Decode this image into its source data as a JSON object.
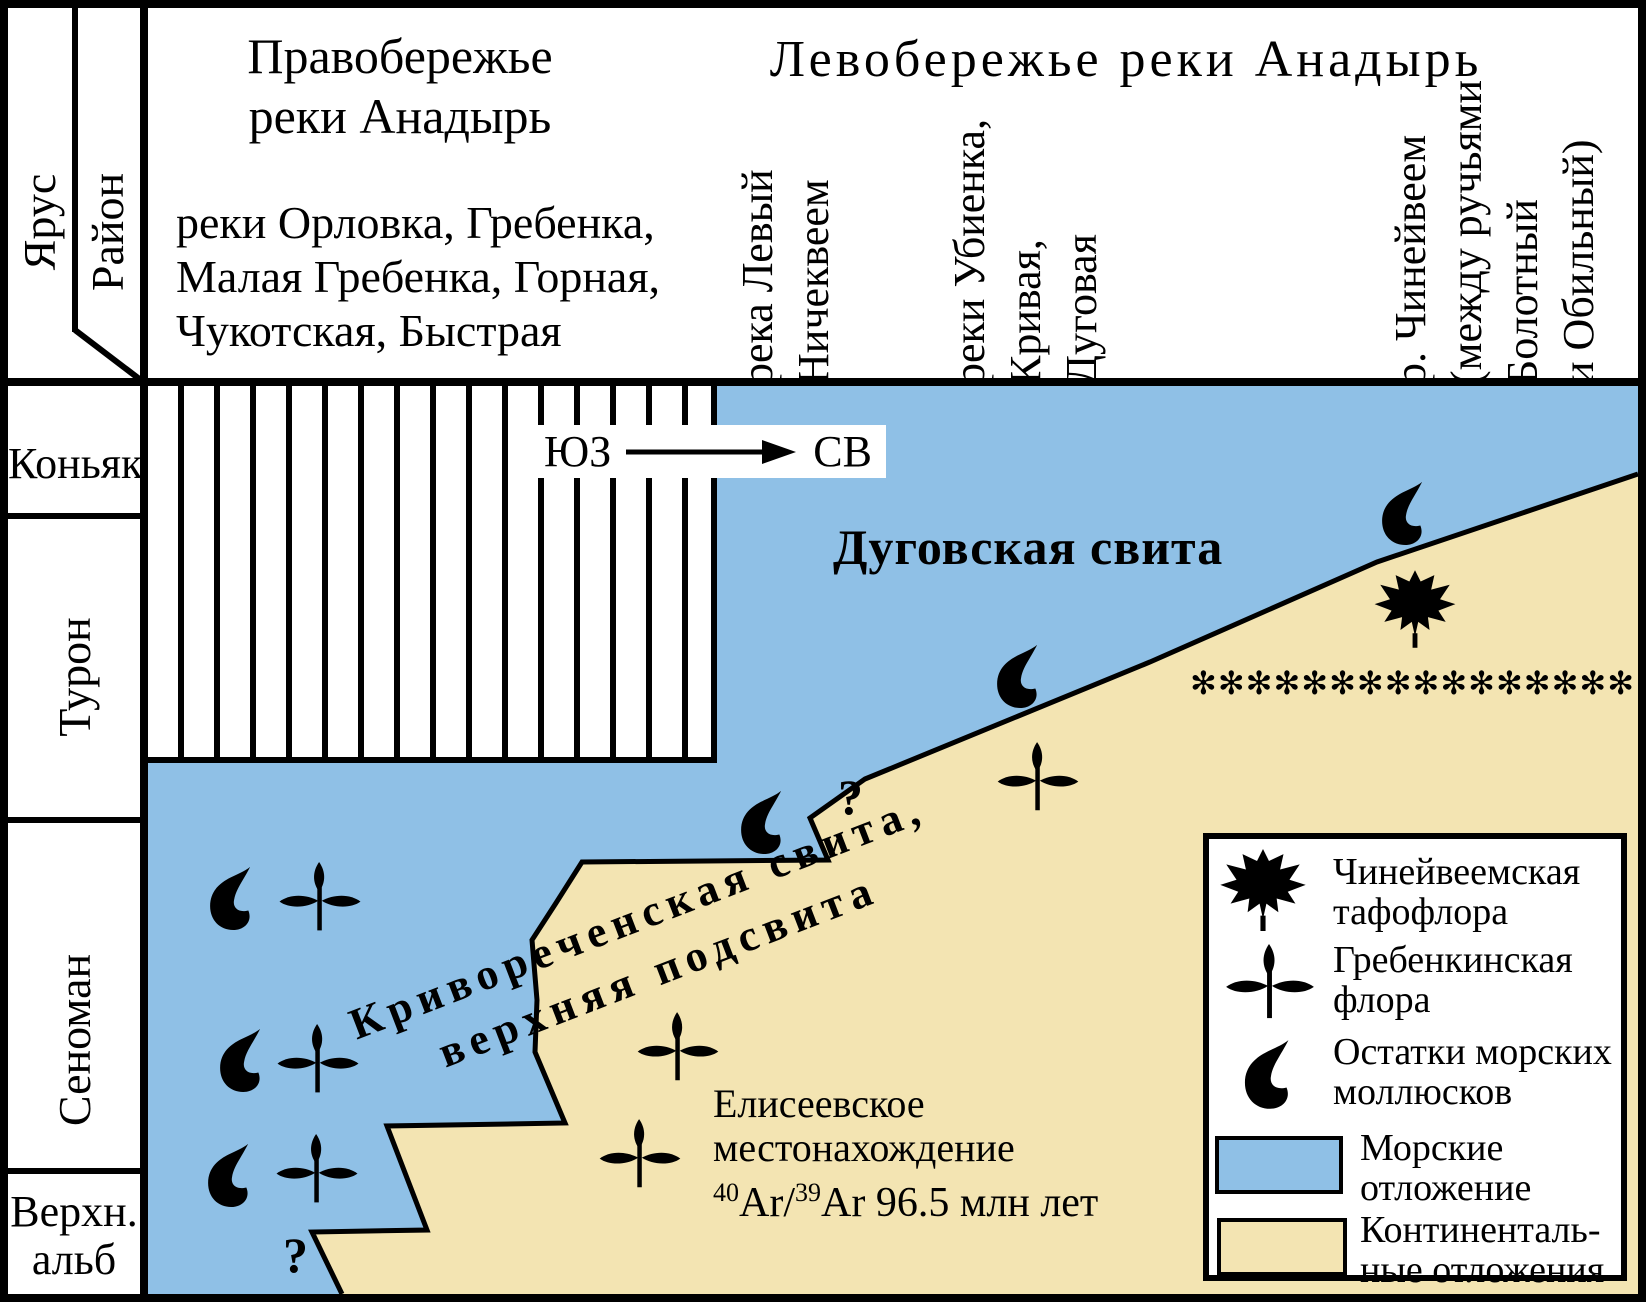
{
  "header": {
    "yarus": "Ярус",
    "raion": "Район",
    "right_bank": {
      "title_line1": "Правобережье",
      "title_line2": "реки Анадырь",
      "rivers": [
        "реки Орловка, Гребенка,",
        "Малая Гребенка, Горная,",
        "Чукотская, Быстрая"
      ]
    },
    "left_bank": {
      "title": "Левобережье реки Анадырь"
    },
    "columns": [
      {
        "lines": [
          "река Левый",
          "Ничеквеем"
        ]
      },
      {
        "lines": [
          "реки Убиенка,",
          "Кривая,",
          "Дуговая"
        ]
      },
      {
        "lines": [
          "р. Чинейвеем",
          "(между ручьями",
          "Болотный",
          "и Обильный)"
        ]
      }
    ]
  },
  "stages": [
    {
      "label": "Коньяк"
    },
    {
      "label": "Турон"
    },
    {
      "label": "Сеноман"
    },
    {
      "line1": "Верхн.",
      "line2": "альб"
    }
  ],
  "chart": {
    "direction_from": "ЮЗ",
    "direction_to": "СВ",
    "dugovskaya": "Дуговская свита",
    "krivorechenskaya_line1": "Криворeченская свита,",
    "krivorechenskaya_line2": "верхняя подсвита",
    "eliseevskoe_line1": "Елисеевское",
    "eliseevskoe_line2": "местонахождение",
    "age": {
      "sup1": "40",
      "base1": "Ar/",
      "sup2": "39",
      "base2": "Ar 96.5 млн лет"
    },
    "question_mark_upper": "?",
    "question_mark_lower": "?",
    "asterisk_row": "✻✻✻✻✻✻✻✻✻✻✻✻✻✻✻✻"
  },
  "legend": {
    "items": [
      {
        "icon": "maple-leaf-icon",
        "lines": [
          "Чинейвеемская",
          "тафофлора"
        ]
      },
      {
        "icon": "flora-icon",
        "lines": [
          "Гребенкинская",
          "флора"
        ]
      },
      {
        "icon": "mollusk-icon",
        "lines": [
          "Остатки морских",
          "моллюсков"
        ]
      },
      {
        "icon": "marine-swatch",
        "lines": [
          "Морские",
          "отложение"
        ]
      },
      {
        "icon": "continental-swatch",
        "lines": [
          "Континенталь-",
          "ные отложения"
        ]
      }
    ]
  },
  "colors": {
    "marine": "#8fc0e6",
    "continental": "#f3e4b2",
    "ink": "#000000"
  }
}
